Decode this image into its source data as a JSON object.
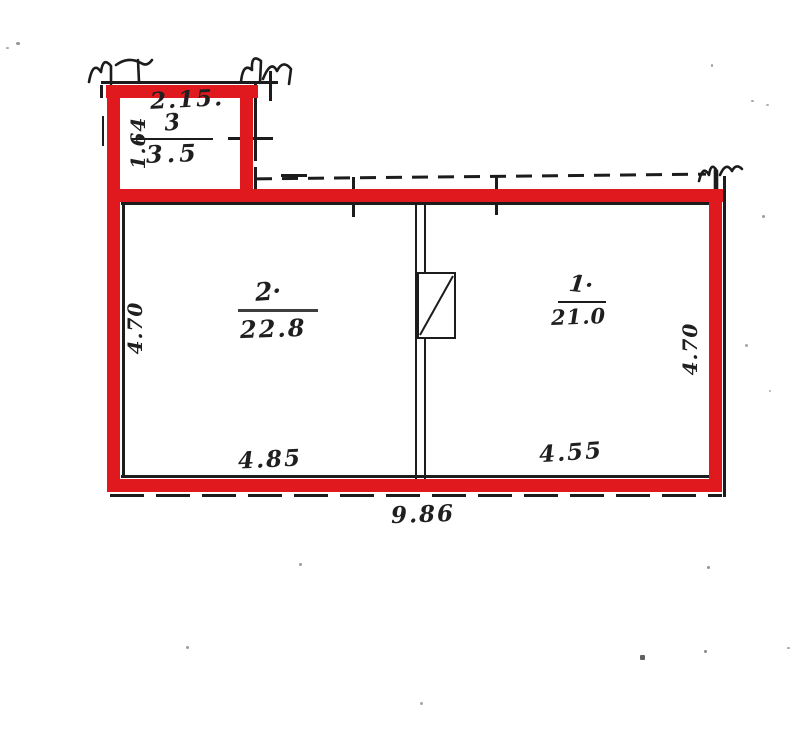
{
  "document": {
    "type": "scanned apartment floor plan with red marker highlight",
    "background_color": "#ffffff",
    "highlight_color": "#e0191f",
    "ink_color": "#1c1c1c"
  },
  "rooms": [
    {
      "number": "3",
      "area": "3.5",
      "width_dim": "2.15.",
      "height_dim": "1.64"
    },
    {
      "number": "2·",
      "area": "22.8",
      "width_dim": "4.85",
      "height_dim": "4.70"
    },
    {
      "number": "1·",
      "area": "21.0",
      "width_dim": "4.55",
      "height_dim": "4.70"
    }
  ],
  "total_width_dim": "9.86"
}
